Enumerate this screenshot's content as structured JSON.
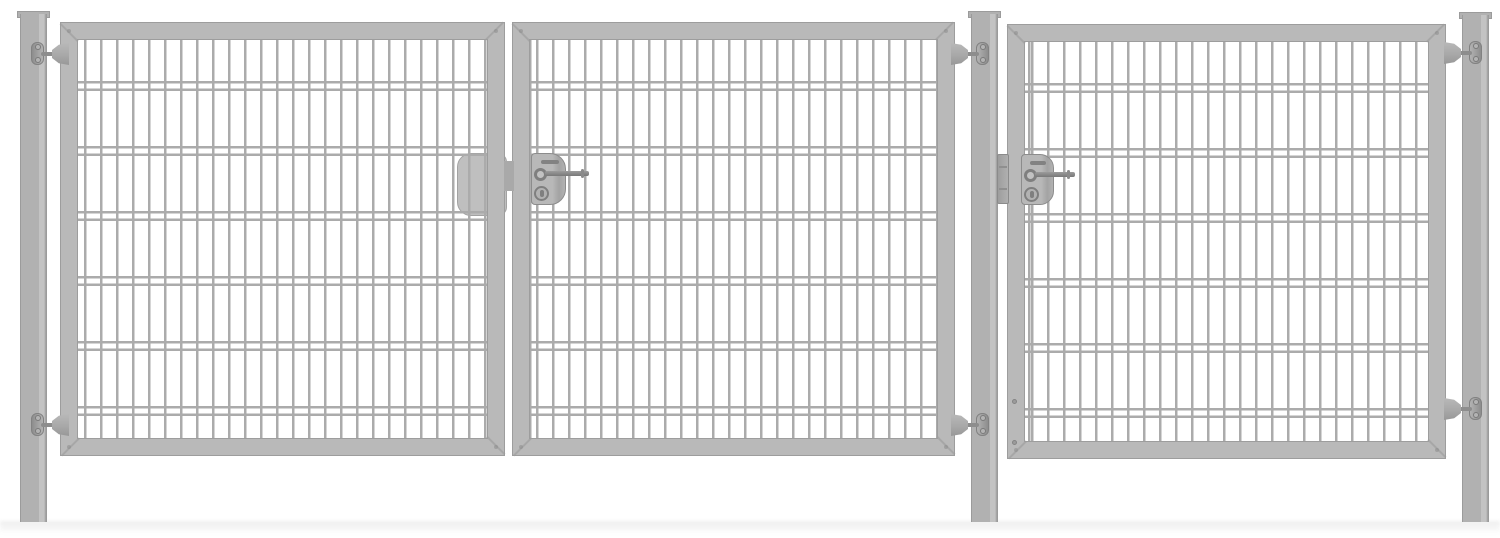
{
  "scene": {
    "type": "product-image",
    "subject": "Triple-panel metal garden gate with double-rod mesh infill, three square posts, hinges and two handle locks",
    "background": "#ffffff"
  },
  "colors": {
    "background": "#ffffff",
    "post": "#b1b1b1",
    "post_edge": "#9b9b9b",
    "post_light": "#c3c3c3",
    "frame": "#b9b9b9",
    "frame_edge": "#9d9d9d",
    "wire": "#ababab",
    "hardware": "#8d8d8d",
    "hardware_light": "#b3b3b3",
    "strike_box": "#bfbfbf",
    "shadow": "#ececec"
  },
  "mesh_pattern": {
    "type": "double-rod-mesh",
    "vertical_wire_spacing_px": 16,
    "wire_width_px": 2.5,
    "horizontal_pair_offset_px": 41,
    "horizontal_pair_gap_px": 5,
    "horizontal_pair_spacing_px": 65
  },
  "components": {
    "posts": [
      {
        "id": "post-left",
        "cap": true
      },
      {
        "id": "post-middle",
        "cap": true
      },
      {
        "id": "post-right",
        "cap": true
      }
    ],
    "gates": [
      {
        "id": "gate-1",
        "hinged_on": "left post",
        "meets": "gate-2 at center lock"
      },
      {
        "id": "gate-2",
        "hinged_on": "middle post",
        "carries": "main lock with handle and cylinder"
      },
      {
        "id": "gate-3",
        "hinged_on": "right post",
        "carries": "side lock with handle and cylinder"
      }
    ],
    "hinges_per_gate": 2,
    "locks": [
      {
        "id": "lock-double-gate",
        "parts": [
          "strike-box",
          "latch",
          "lock-plate",
          "slot",
          "handle-lever",
          "profile-cylinder"
        ]
      },
      {
        "id": "lock-side-gate",
        "parts": [
          "post-bracket",
          "lock-plate",
          "slot",
          "handle-lever",
          "profile-cylinder"
        ]
      }
    ]
  }
}
